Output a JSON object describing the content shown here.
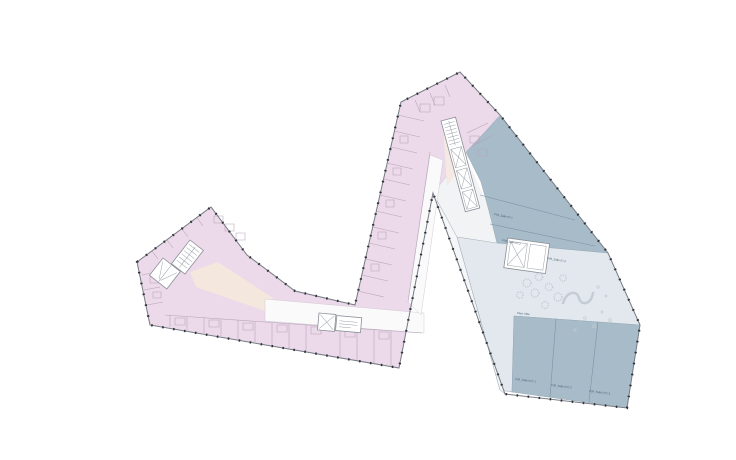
{
  "document": {
    "kind": "architectural floor plan drawing",
    "background_color": "#ffffff"
  },
  "plan": {
    "colors": {
      "residential_fill": "#ecd9e9",
      "residential_partition": "#b5a4ba",
      "hall_dark_fill": "#a7bbc9",
      "hall_light_fill": "#e2e8ee",
      "foyer_strip_fill": "#f4f6f7",
      "lobby_cream_fill": "#f3e7de",
      "facade_line": "#767b84",
      "facade_column_dot": "#2e3138",
      "label_color": "#4a5f71"
    },
    "labels": {
      "upper_room_labels": [
        "P09_Salle 07.1",
        "P09_Salle 07.2",
        "P09_Salle 07.3"
      ],
      "lower_room_labels": [
        "P09_Salle 07C.1",
        "P09_Salle 07C.2",
        "P09_Salle 07C.3"
      ],
      "edge_label": "Plein Vide"
    }
  }
}
